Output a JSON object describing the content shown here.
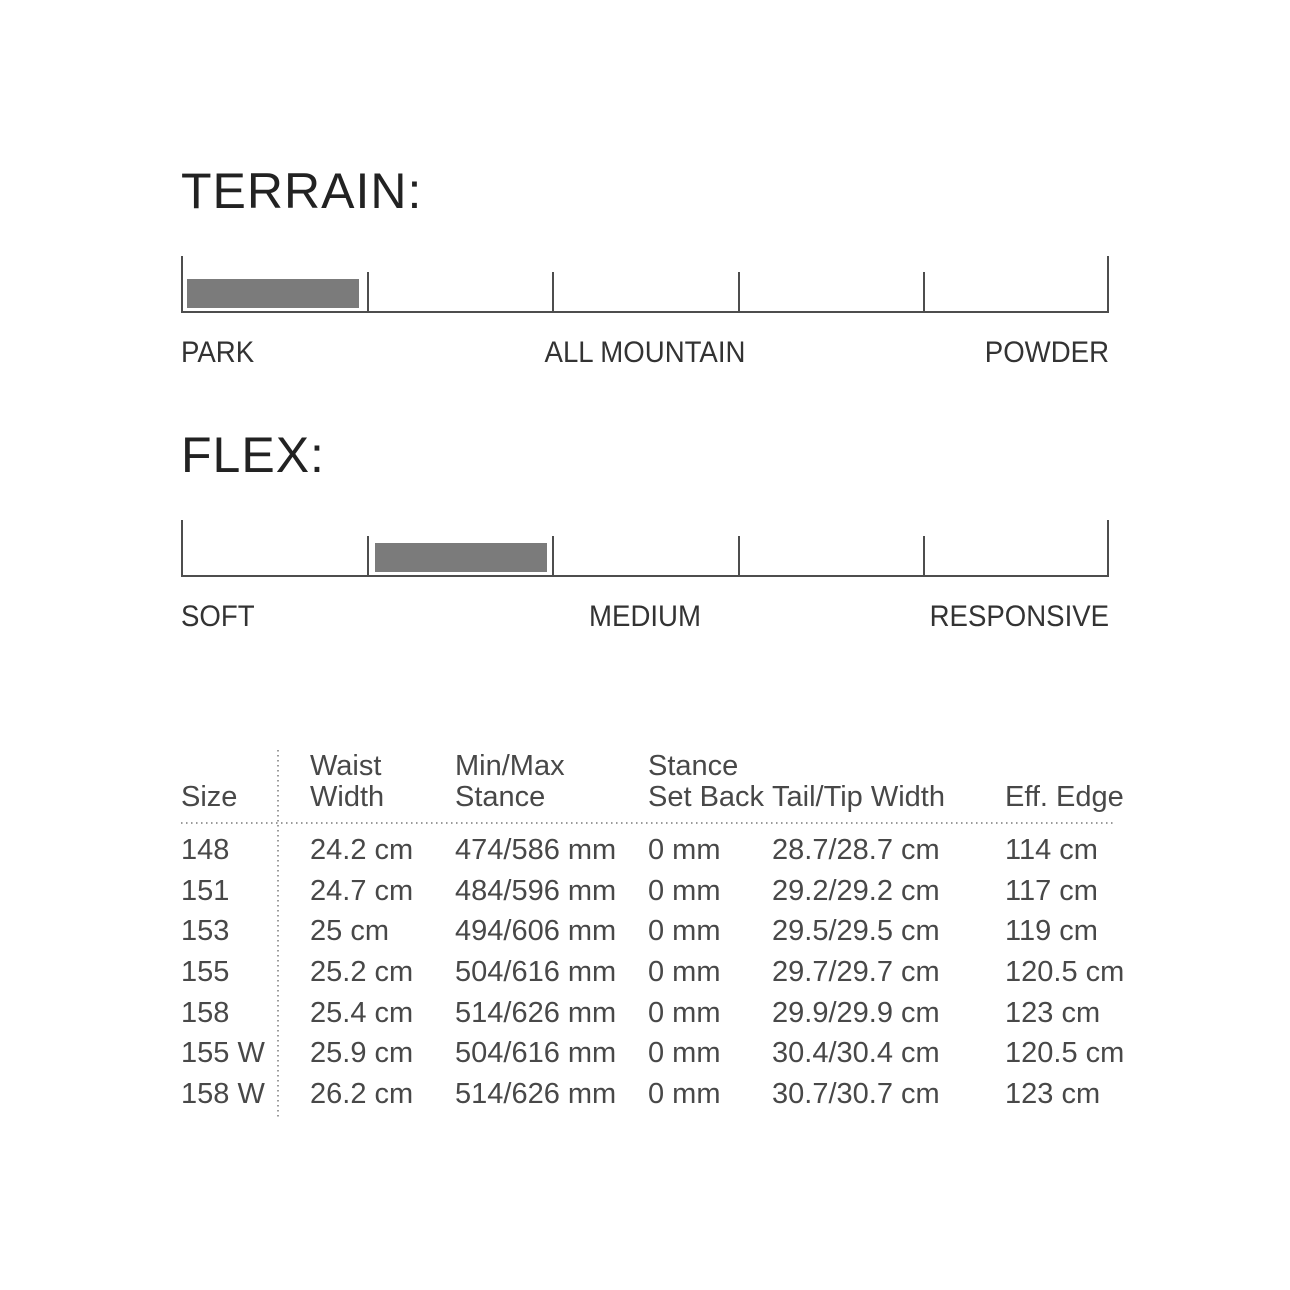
{
  "terrain": {
    "title": "TERRAIN:",
    "labels": [
      "PARK",
      "ALL MOUNTAIN",
      "POWDER"
    ],
    "segments_total": 5,
    "filled_segment": 1
  },
  "flex": {
    "title": "FLEX:",
    "labels": [
      "SOFT",
      "MEDIUM",
      "RESPONSIVE"
    ],
    "segments_total": 5,
    "filled_segment": 2
  },
  "colors": {
    "bar_fill": "#7b7b7b",
    "scale_line": "#4d4d4d",
    "dotted_line": "#9a9a9a",
    "title_text": "#222222",
    "table_text": "#484848"
  },
  "table": {
    "headers": {
      "size": "Size",
      "waist_line1": "Waist",
      "waist_line2": "Width",
      "minmax_line1": "Min/Max",
      "minmax_line2": "Stance",
      "setback_line1": "Stance",
      "setback_line2": "Set Back",
      "tailtip": "Tail/Tip Width",
      "effedge": "Eff. Edge"
    },
    "rows": [
      {
        "size": "148",
        "waist": "24.2 cm",
        "stance": "474/586 mm",
        "setback": "0 mm",
        "tailtip": "28.7/28.7 cm",
        "effedge": "114 cm"
      },
      {
        "size": "151",
        "waist": "24.7 cm",
        "stance": "484/596 mm",
        "setback": "0 mm",
        "tailtip": "29.2/29.2 cm",
        "effedge": "117 cm"
      },
      {
        "size": "153",
        "waist": "25 cm",
        "stance": "494/606 mm",
        "setback": "0 mm",
        "tailtip": "29.5/29.5 cm",
        "effedge": "119 cm"
      },
      {
        "size": "155",
        "waist": "25.2 cm",
        "stance": "504/616 mm",
        "setback": "0 mm",
        "tailtip": "29.7/29.7 cm",
        "effedge": "120.5 cm"
      },
      {
        "size": "158",
        "waist": "25.4 cm",
        "stance": "514/626 mm",
        "setback": "0 mm",
        "tailtip": "29.9/29.9 cm",
        "effedge": "123 cm"
      },
      {
        "size": "155 W",
        "waist": "25.9 cm",
        "stance": "504/616 mm",
        "setback": "0 mm",
        "tailtip": "30.4/30.4 cm",
        "effedge": "120.5 cm"
      },
      {
        "size": "158 W",
        "waist": "26.2 cm",
        "stance": "514/626 mm",
        "setback": "0 mm",
        "tailtip": "30.7/30.7 cm",
        "effedge": "123 cm"
      }
    ]
  }
}
